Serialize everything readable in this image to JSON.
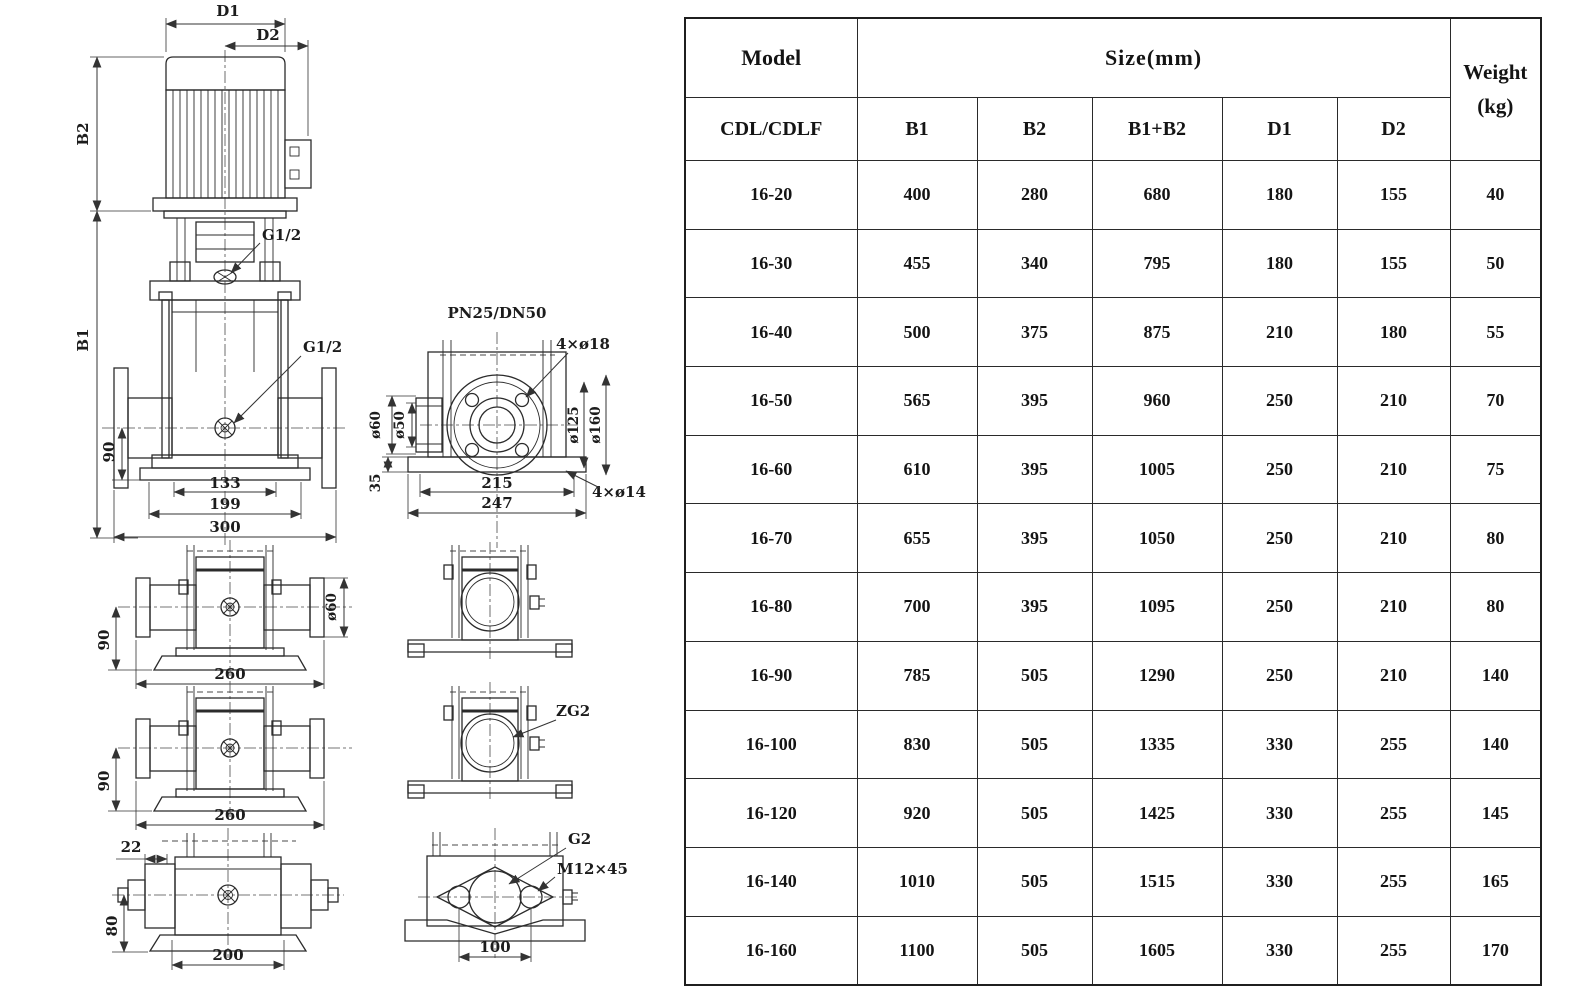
{
  "colors": {
    "paper": "#ffffff",
    "ink": "#1f1f1f"
  },
  "drawings": {
    "front_view": {
      "dim_d1": "D1",
      "dim_d2": "D2",
      "dim_b2": "B2",
      "dim_b1": "B1",
      "port_top": "G1/2",
      "port_mid": "G1/2",
      "dim_90": "90",
      "dim_133": "133",
      "dim_199": "199",
      "dim_300": "300"
    },
    "flange_view": {
      "title": "PN25/DN50",
      "bolt_top": "4×ø18",
      "bolt_base": "4×ø14",
      "dia_60": "ø60",
      "dia_50": "ø50",
      "dia_125": "ø125",
      "dia_160": "ø160",
      "dim_35": "35",
      "dim_215": "215",
      "dim_247": "247"
    },
    "side_view_a": {
      "dim_90": "90",
      "dim_260": "260",
      "dia_60": "ø60"
    },
    "side_view_b": {
      "dim_90": "90",
      "dim_260": "260"
    },
    "port_view_b": {
      "thread": "ZG2"
    },
    "bottom_view": {
      "dim_22": "22",
      "dim_80": "80",
      "dim_200": "200"
    },
    "port_view_c": {
      "thread": "G2",
      "bolt": "M12×45",
      "dim_100": "100"
    }
  },
  "table": {
    "header": {
      "model": "Model",
      "size": "Size(mm)",
      "weight": "Weight",
      "weight_unit": "(kg)",
      "model_sub": "CDL/CDLF",
      "size_sub": [
        "B1",
        "B2",
        "B1+B2",
        "D1",
        "D2"
      ]
    },
    "rows": [
      {
        "model": "16-20",
        "b1": "400",
        "b2": "280",
        "b1b2": "680",
        "d1": "180",
        "d2": "155",
        "weight": "40"
      },
      {
        "model": "16-30",
        "b1": "455",
        "b2": "340",
        "b1b2": "795",
        "d1": "180",
        "d2": "155",
        "weight": "50"
      },
      {
        "model": "16-40",
        "b1": "500",
        "b2": "375",
        "b1b2": "875",
        "d1": "210",
        "d2": "180",
        "weight": "55"
      },
      {
        "model": "16-50",
        "b1": "565",
        "b2": "395",
        "b1b2": "960",
        "d1": "250",
        "d2": "210",
        "weight": "70"
      },
      {
        "model": "16-60",
        "b1": "610",
        "b2": "395",
        "b1b2": "1005",
        "d1": "250",
        "d2": "210",
        "weight": "75"
      },
      {
        "model": "16-70",
        "b1": "655",
        "b2": "395",
        "b1b2": "1050",
        "d1": "250",
        "d2": "210",
        "weight": "80"
      },
      {
        "model": "16-80",
        "b1": "700",
        "b2": "395",
        "b1b2": "1095",
        "d1": "250",
        "d2": "210",
        "weight": "80"
      },
      {
        "model": "16-90",
        "b1": "785",
        "b2": "505",
        "b1b2": "1290",
        "d1": "250",
        "d2": "210",
        "weight": "140"
      },
      {
        "model": "16-100",
        "b1": "830",
        "b2": "505",
        "b1b2": "1335",
        "d1": "330",
        "d2": "255",
        "weight": "140"
      },
      {
        "model": "16-120",
        "b1": "920",
        "b2": "505",
        "b1b2": "1425",
        "d1": "330",
        "d2": "255",
        "weight": "145"
      },
      {
        "model": "16-140",
        "b1": "1010",
        "b2": "505",
        "b1b2": "1515",
        "d1": "330",
        "d2": "255",
        "weight": "165"
      },
      {
        "model": "16-160",
        "b1": "1100",
        "b2": "505",
        "b1b2": "1605",
        "d1": "330",
        "d2": "255",
        "weight": "170"
      }
    ]
  }
}
